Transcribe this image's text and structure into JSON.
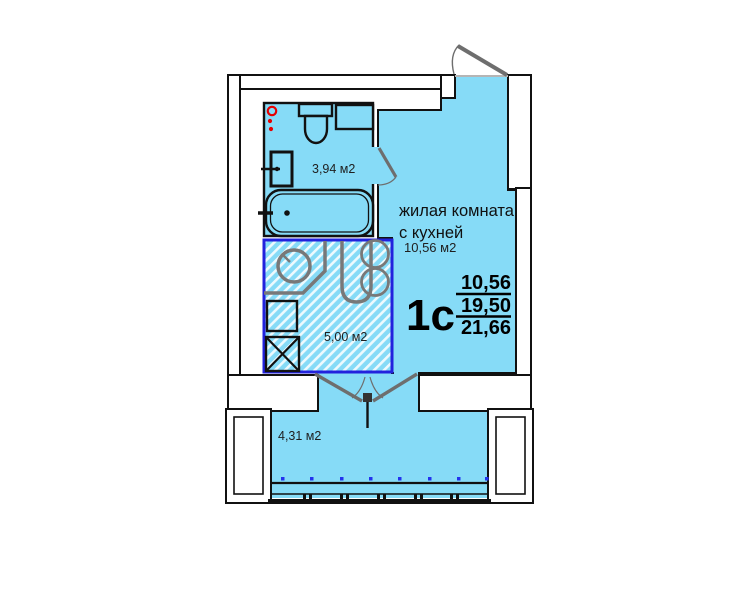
{
  "floor_plan": {
    "unit_code": "1с",
    "area_stack": {
      "living": "10,56",
      "total": "19,50",
      "overall": "21,66"
    },
    "labels": {
      "bathroom_area": "3,94 м2",
      "living_line1": "жилая комната",
      "living_line2": "с кухней",
      "living_area": "10,56 м2",
      "kitchen_area": "5,00 м2",
      "balcony_area": "4,31 м2"
    },
    "colors": {
      "room_fill": "#86DBF7",
      "kitchen_zone_border": "#2222DD",
      "fixture_gray": "#6e6e6e",
      "riser_red": "#E60000",
      "window_dot_blue": "#2233EE",
      "line_black": "#111111"
    }
  }
}
